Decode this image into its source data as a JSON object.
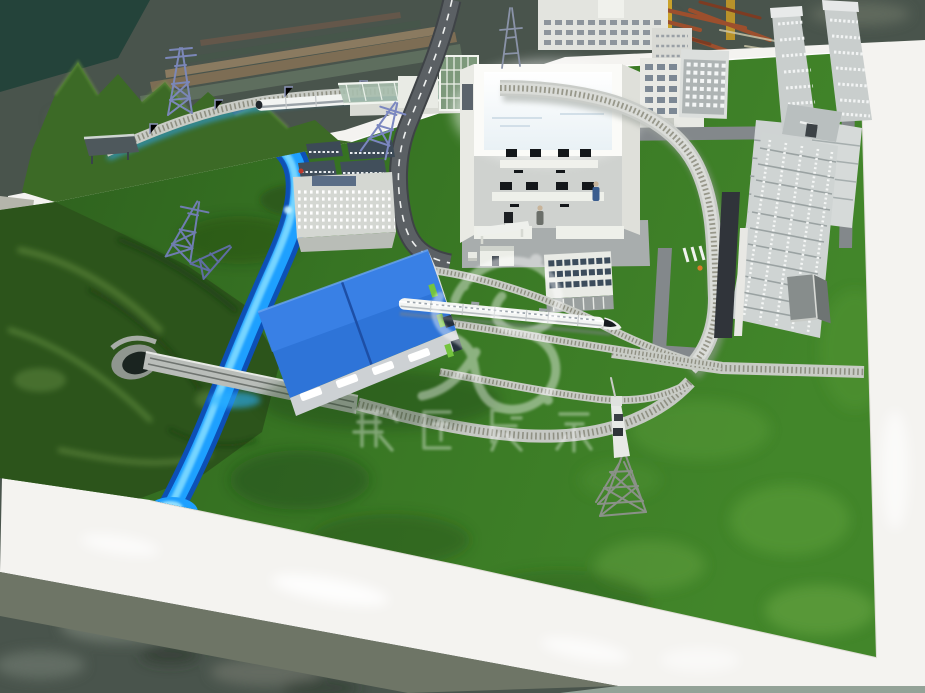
{
  "scene": {
    "caption": "Photograph of a physical high-speed railway exhibition scale model on a white-framed base table",
    "elements": {
      "terrain": "green mountains and lawns",
      "water": "LED-lit blue river with tunnel and rail bridge",
      "rolling_stock": "white high-speed EMU trains",
      "buildings": "blue-roof depot, cutaway control building with glowing screen, silver skyscrapers, office blocks"
    }
  },
  "watermark": {
    "characters": "数匠展示",
    "logo": "swirl-flower-watermark",
    "opacity": "0.4"
  },
  "palette": {
    "floor": "#49544c",
    "floor_dark": "#303a33",
    "frame_white": "#f4f3f0",
    "frame_side": "#6e7566",
    "frame_sliver": "#93a297",
    "grass": "#3f8127",
    "grass_dark": "#2f6620",
    "mountain": "#2c541b",
    "river_core": "#1ea0ff",
    "river_glow": "#7fdaff",
    "river_deep": "#0c4fbf",
    "depot_blue": "#2e74d8",
    "road_asphalt": "#5b6064",
    "road_light": "#83888b",
    "track_grey": "#c9ccc6",
    "building_white": "#eceee9",
    "window_dark": "#46505a",
    "lit_window": "#ffffff",
    "skyscraper_silver": "#c9cecd",
    "pylon_blue": "#6f7db0",
    "pole_yellow": "#caa22a",
    "accent_green": "#74c43e"
  }
}
